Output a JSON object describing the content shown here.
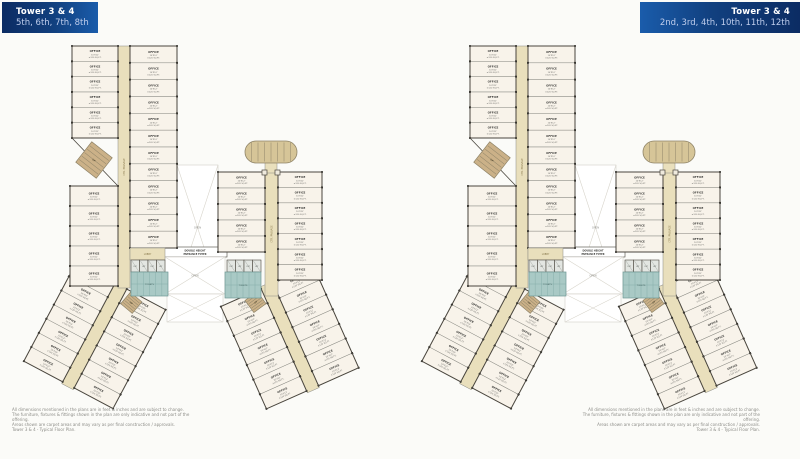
{
  "banner_left": {
    "title": "Tower 3 & 4",
    "floors": "5th, 6th, 7th, 8th"
  },
  "banner_right": {
    "title": "Tower 3 & 4",
    "floors": "2nd, 3rd, 4th, 10th, 11th, 12th"
  },
  "plan": {
    "unit_label": "OFFICE",
    "unit_dim": "10'X12'",
    "unit_area": "±120 SQ.FT.",
    "corridor_label": "CTR. PASSAGE",
    "open_label": "OPEN",
    "foyer_line1": "DOUBLE HEIGHT",
    "foyer_line2": "ENTRANCE FOYER",
    "lobby_label": "LOBBY",
    "lift_label": "LIFT",
    "toilet_label": "TOILETS",
    "stair_label": "UP",
    "counts": {
      "north_left_top": 6,
      "north_left_bottom": 5,
      "north_right": 12,
      "east_left": 5,
      "east_right": 7,
      "leg_side": 7
    }
  },
  "disclaimer_left": [
    "All dimensions mentioned in the plans are in feet & inches and are subject to change.",
    "The furniture, fixtures & fittings shown in the plan are only indicative and not part of the offering.",
    "Areas shown are carpet areas and may vary as per final construction / approvals.",
    "Tower 3 & 4 - Typical Floor Plan."
  ],
  "disclaimer_right": [
    "All dimensions mentioned in the plans are in feet & inches and are subject to change.",
    "The furniture, fixtures & fittings shown in the plan are only indicative and not part of the offering.",
    "Areas shown are carpet areas and may vary as per final construction / approvals.",
    "Tower 3 & 4 - Typical Floor Plan."
  ],
  "colors": {
    "unit": "#f8f3ea",
    "corridor": "#e9dfbc",
    "wall": "#4a463e",
    "wall_light": "#8a8a83",
    "dot": "#1d1d1b",
    "teal": "#a9c9c5",
    "teal_line": "#7fa8a4",
    "stair": "#cbb188",
    "oval": "#d6c598",
    "xline": "#d8d5cc",
    "label": "#6a6a66",
    "accent": "#11407f"
  }
}
